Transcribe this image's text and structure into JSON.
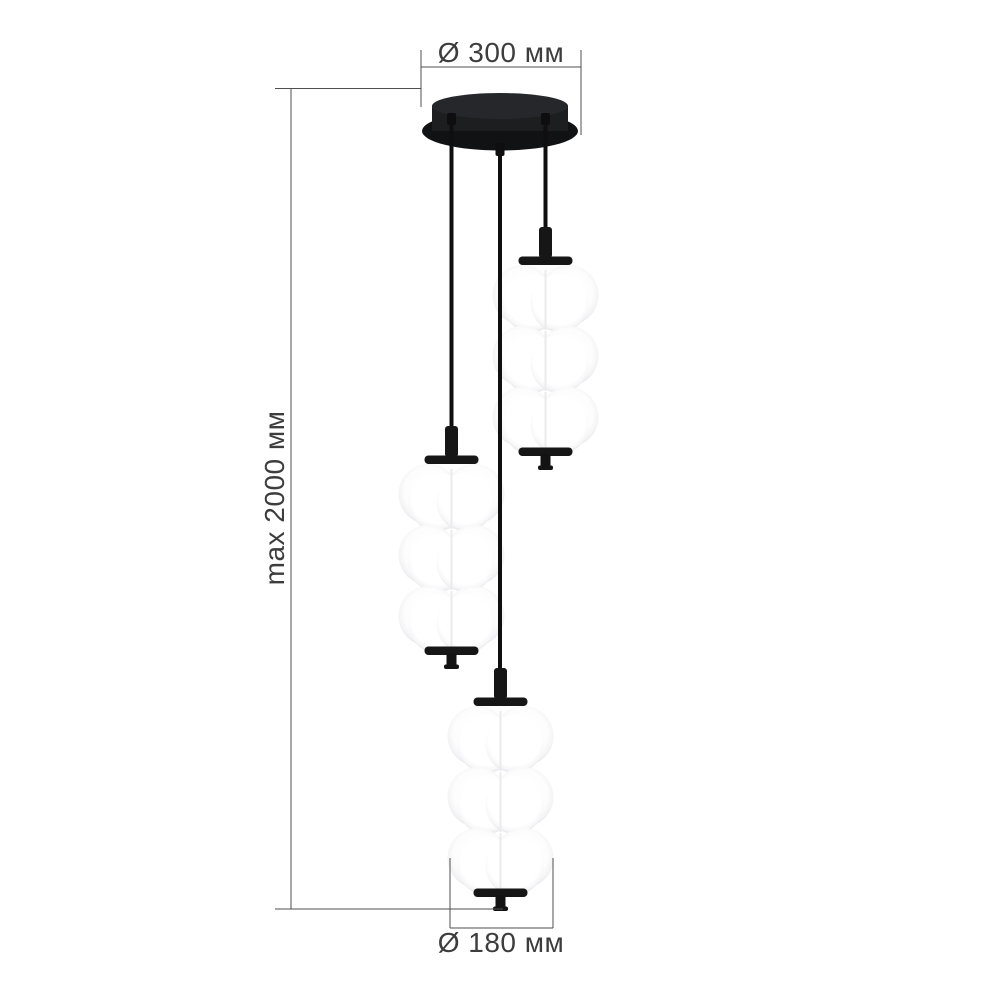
{
  "diagram": {
    "subject": "Three-light cluster pendant chandelier with stacked opal-white glass shades on a round black ceiling canopy",
    "pendants": 3,
    "shade_tiers_per_pendant": 3,
    "measurements": {
      "canopy_diameter_mm": 300,
      "max_suspension_mm": 2000,
      "shade_diameter_mm": 180
    }
  },
  "labels": {
    "canopy_diameter": "Ø 300 мм",
    "max_height": "max 2000 мм",
    "shade_diameter": "Ø 180 мм"
  },
  "colors": {
    "background": "#ffffff",
    "fixture_black": "#1a1a1a",
    "cord_black": "#0f0f10",
    "glass_white": "#ffffff",
    "glass_shade_edge": "#e9e9eb",
    "dimension_line": "#4f4f4f",
    "label_text": "#3d3d3d"
  }
}
